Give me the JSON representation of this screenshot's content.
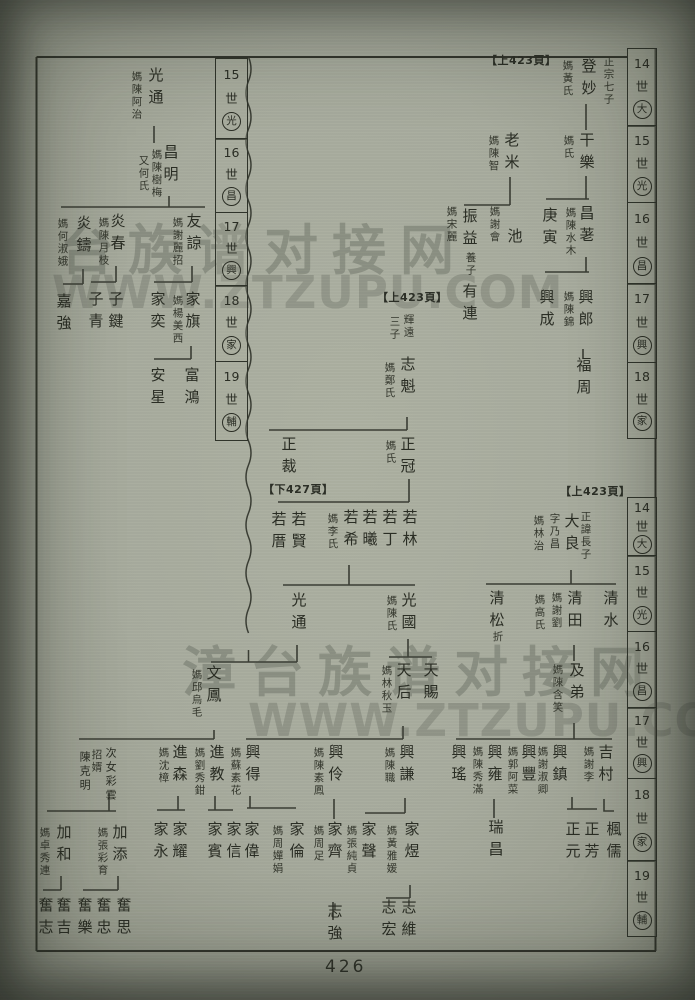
{
  "page": {
    "number": "426"
  },
  "colors": {
    "paper": "#a7ab9d",
    "ink": "#2a2d24",
    "line": "#3a3d34"
  },
  "watermarks": [
    {
      "text": "台族谱对接网",
      "x": 60,
      "y": 206,
      "size": 54,
      "kind": "cn"
    },
    {
      "text": "WWW.ZTZUPU.COM",
      "x": 52,
      "y": 266,
      "size": 45,
      "kind": "url"
    },
    {
      "text": "漳台族谱对接网",
      "x": 182,
      "y": 628,
      "size": 54,
      "kind": "cn"
    },
    {
      "text": "WWW.ZTZUPU.COM",
      "x": 248,
      "y": 694,
      "size": 45,
      "kind": "url"
    }
  ],
  "refs": [
    {
      "text": "【上423頁】",
      "x": 486,
      "y": 52
    },
    {
      "text": "【上423頁】",
      "x": 377,
      "y": 289
    },
    {
      "text": "【下427頁】",
      "x": 263,
      "y": 481
    },
    {
      "text": "【上423頁】",
      "x": 560,
      "y": 483
    }
  ],
  "bands": [
    {
      "x": 627,
      "y": 48,
      "w": 30,
      "cells": [
        {
          "n": "14",
          "g": "大",
          "h": 79
        },
        {
          "n": "15",
          "g": "光",
          "h": 78
        },
        {
          "n": "16",
          "g": "昌",
          "h": 83
        },
        {
          "n": "17",
          "g": "興",
          "h": 80
        },
        {
          "n": "18",
          "g": "家",
          "h": 77
        }
      ]
    },
    {
      "x": 627,
      "y": 497,
      "w": 30,
      "cells": [
        {
          "n": "14",
          "g": "大",
          "h": 60
        },
        {
          "n": "15",
          "g": "光",
          "h": 77
        },
        {
          "n": "16",
          "g": "昌",
          "h": 78
        },
        {
          "n": "17",
          "g": "興",
          "h": 72
        },
        {
          "n": "18",
          "g": "家",
          "h": 84
        },
        {
          "n": "19",
          "g": "輔",
          "h": 77
        }
      ]
    },
    {
      "x": 215,
      "y": 58,
      "w": 33,
      "cells": [
        {
          "n": "15",
          "g": "光",
          "h": 82
        },
        {
          "n": "16",
          "g": "昌",
          "h": 75
        },
        {
          "n": "17",
          "g": "興",
          "h": 75
        },
        {
          "n": "18",
          "g": "家",
          "h": 77
        },
        {
          "n": "19",
          "g": "輔",
          "h": 80
        }
      ]
    }
  ],
  "people": [
    {
      "t": "正宗七子",
      "x": 602,
      "y": 56,
      "s": 10,
      "k": "note"
    },
    {
      "t": "登妙",
      "x": 580,
      "y": 58,
      "s": 15,
      "k": "name"
    },
    {
      "t": "媽黃氏",
      "x": 561,
      "y": 60,
      "s": 10,
      "k": "spouse"
    },
    {
      "t": "干樂",
      "x": 578,
      "y": 132,
      "s": 15,
      "k": "name"
    },
    {
      "t": "媽氏",
      "x": 562,
      "y": 135,
      "s": 10,
      "k": "spouse"
    },
    {
      "t": "老米",
      "x": 503,
      "y": 132,
      "s": 15,
      "k": "name"
    },
    {
      "t": "媽陳智",
      "x": 487,
      "y": 135,
      "s": 10,
      "k": "spouse"
    },
    {
      "t": "昌荖",
      "x": 578,
      "y": 205,
      "s": 15,
      "k": "name"
    },
    {
      "t": "媽陳水木",
      "x": 564,
      "y": 207,
      "s": 10,
      "k": "spouse"
    },
    {
      "t": "庚寅",
      "x": 541,
      "y": 207,
      "s": 15,
      "k": "name"
    },
    {
      "t": "池",
      "x": 506,
      "y": 228,
      "s": 15,
      "k": "name"
    },
    {
      "t": "媽謝會",
      "x": 488,
      "y": 206,
      "s": 10,
      "k": "spouse"
    },
    {
      "t": "振益",
      "x": 461,
      "y": 208,
      "s": 15,
      "k": "name"
    },
    {
      "t": "養子",
      "x": 464,
      "y": 252,
      "s": 10,
      "k": "note"
    },
    {
      "t": "有連",
      "x": 461,
      "y": 283,
      "s": 15,
      "k": "name"
    },
    {
      "t": "媽宋麗",
      "x": 445,
      "y": 206,
      "s": 10,
      "k": "spouse"
    },
    {
      "t": "興郎",
      "x": 577,
      "y": 289,
      "s": 15,
      "k": "name"
    },
    {
      "t": "媽陳錦",
      "x": 562,
      "y": 291,
      "s": 10,
      "k": "spouse"
    },
    {
      "t": "興成",
      "x": 538,
      "y": 289,
      "s": 15,
      "k": "name"
    },
    {
      "t": "福周",
      "x": 575,
      "y": 357,
      "s": 15,
      "k": "name"
    },
    {
      "t": "正諱長子",
      "x": 579,
      "y": 511,
      "s": 10,
      "k": "note"
    },
    {
      "t": "大良",
      "x": 563,
      "y": 513,
      "s": 15,
      "k": "name"
    },
    {
      "t": "字乃昌",
      "x": 548,
      "y": 513,
      "s": 10,
      "k": "note"
    },
    {
      "t": "媽林治",
      "x": 532,
      "y": 515,
      "s": 10,
      "k": "spouse"
    },
    {
      "t": "清水",
      "x": 602,
      "y": 590,
      "s": 15,
      "k": "name"
    },
    {
      "t": "清田",
      "x": 566,
      "y": 590,
      "s": 15,
      "k": "name"
    },
    {
      "t": "媽謝劉",
      "x": 550,
      "y": 592,
      "s": 10,
      "k": "spouse"
    },
    {
      "t": "媽高氏",
      "x": 533,
      "y": 594,
      "s": 10,
      "k": "spouse"
    },
    {
      "t": "清松",
      "x": 488,
      "y": 590,
      "s": 15,
      "k": "name"
    },
    {
      "t": "折",
      "x": 491,
      "y": 631,
      "s": 10,
      "k": "note"
    },
    {
      "t": "及弟",
      "x": 568,
      "y": 662,
      "s": 15,
      "k": "name"
    },
    {
      "t": "媽陳含笑",
      "x": 551,
      "y": 664,
      "s": 10,
      "k": "spouse"
    },
    {
      "t": "吉村",
      "x": 597,
      "y": 744,
      "s": 15,
      "k": "name"
    },
    {
      "t": "媽謝李",
      "x": 582,
      "y": 746,
      "s": 10,
      "k": "spouse"
    },
    {
      "t": "興鎮",
      "x": 551,
      "y": 744,
      "s": 15,
      "k": "name"
    },
    {
      "t": "媽謝淑卿",
      "x": 536,
      "y": 746,
      "s": 10,
      "k": "spouse"
    },
    {
      "t": "興豐",
      "x": 520,
      "y": 744,
      "s": 15,
      "k": "name"
    },
    {
      "t": "媽郭阿菜",
      "x": 506,
      "y": 746,
      "s": 10,
      "k": "spouse"
    },
    {
      "t": "興雍",
      "x": 486,
      "y": 744,
      "s": 15,
      "k": "name"
    },
    {
      "t": "媽陳秀滿",
      "x": 471,
      "y": 746,
      "s": 10,
      "k": "spouse"
    },
    {
      "t": "興瑤",
      "x": 450,
      "y": 744,
      "s": 15,
      "k": "name"
    },
    {
      "t": "楓儒",
      "x": 605,
      "y": 821,
      "s": 15,
      "k": "name"
    },
    {
      "t": "正芳",
      "x": 583,
      "y": 821,
      "s": 15,
      "k": "name"
    },
    {
      "t": "正元",
      "x": 564,
      "y": 821,
      "s": 15,
      "k": "name"
    },
    {
      "t": "瑞昌",
      "x": 487,
      "y": 819,
      "s": 15,
      "k": "name"
    },
    {
      "t": "光通",
      "x": 147,
      "y": 67,
      "s": 15,
      "k": "name"
    },
    {
      "t": "媽陳阿治",
      "x": 130,
      "y": 71,
      "s": 10,
      "k": "spouse"
    },
    {
      "t": "昌明",
      "x": 162,
      "y": 144,
      "s": 15,
      "k": "name"
    },
    {
      "t": "媽陳樹梅",
      "x": 150,
      "y": 149,
      "s": 10,
      "k": "spouse"
    },
    {
      "t": "又何氏",
      "x": 137,
      "y": 155,
      "s": 10,
      "k": "spouse"
    },
    {
      "t": "友諒",
      "x": 185,
      "y": 213,
      "s": 15,
      "k": "name"
    },
    {
      "t": "媽謝麗招",
      "x": 171,
      "y": 217,
      "s": 10,
      "k": "spouse"
    },
    {
      "t": "炎春",
      "x": 109,
      "y": 213,
      "s": 15,
      "k": "name"
    },
    {
      "t": "媽陳月枝",
      "x": 97,
      "y": 217,
      "s": 10,
      "k": "spouse"
    },
    {
      "t": "炎鑄",
      "x": 75,
      "y": 215,
      "s": 15,
      "k": "name"
    },
    {
      "t": "媽何淑娥",
      "x": 56,
      "y": 218,
      "s": 10,
      "k": "spouse"
    },
    {
      "t": "家旗",
      "x": 184,
      "y": 291,
      "s": 15,
      "k": "name"
    },
    {
      "t": "媽楊美西",
      "x": 171,
      "y": 295,
      "s": 10,
      "k": "spouse"
    },
    {
      "t": "家奕",
      "x": 149,
      "y": 291,
      "s": 15,
      "k": "name"
    },
    {
      "t": "子鍵",
      "x": 107,
      "y": 291,
      "s": 15,
      "k": "name"
    },
    {
      "t": "子青",
      "x": 87,
      "y": 291,
      "s": 15,
      "k": "name"
    },
    {
      "t": "嘉強",
      "x": 55,
      "y": 293,
      "s": 15,
      "k": "name"
    },
    {
      "t": "富鴻",
      "x": 183,
      "y": 367,
      "s": 15,
      "k": "name"
    },
    {
      "t": "安星",
      "x": 149,
      "y": 367,
      "s": 15,
      "k": "name"
    },
    {
      "t": "輝遠",
      "x": 402,
      "y": 314,
      "s": 10,
      "k": "note"
    },
    {
      "t": "三子",
      "x": 388,
      "y": 316,
      "s": 10,
      "k": "note"
    },
    {
      "t": "志魁",
      "x": 399,
      "y": 356,
      "s": 15,
      "k": "name"
    },
    {
      "t": "媽鄭氏",
      "x": 383,
      "y": 362,
      "s": 10,
      "k": "spouse"
    },
    {
      "t": "正冠",
      "x": 399,
      "y": 436,
      "s": 15,
      "k": "name"
    },
    {
      "t": "媽氏",
      "x": 384,
      "y": 440,
      "s": 10,
      "k": "spouse"
    },
    {
      "t": "正裁",
      "x": 280,
      "y": 436,
      "s": 15,
      "k": "name"
    },
    {
      "t": "若林",
      "x": 401,
      "y": 509,
      "s": 15,
      "k": "name"
    },
    {
      "t": "若丁",
      "x": 381,
      "y": 509,
      "s": 15,
      "k": "name"
    },
    {
      "t": "若曦",
      "x": 361,
      "y": 509,
      "s": 15,
      "k": "name"
    },
    {
      "t": "若希",
      "x": 342,
      "y": 509,
      "s": 15,
      "k": "name"
    },
    {
      "t": "媽李氏",
      "x": 326,
      "y": 513,
      "s": 10,
      "k": "spouse"
    },
    {
      "t": "若賢",
      "x": 290,
      "y": 511,
      "s": 15,
      "k": "name"
    },
    {
      "t": "若厝",
      "x": 270,
      "y": 511,
      "s": 15,
      "k": "name"
    },
    {
      "t": "光國",
      "x": 400,
      "y": 592,
      "s": 15,
      "k": "name"
    },
    {
      "t": "媽陳氏",
      "x": 385,
      "y": 595,
      "s": 10,
      "k": "spouse"
    },
    {
      "t": "光通",
      "x": 290,
      "y": 592,
      "s": 15,
      "k": "name"
    },
    {
      "t": "天賜",
      "x": 422,
      "y": 662,
      "s": 15,
      "k": "name"
    },
    {
      "t": "天后",
      "x": 395,
      "y": 662,
      "s": 15,
      "k": "name"
    },
    {
      "t": "媽林秋玉",
      "x": 380,
      "y": 665,
      "s": 10,
      "k": "spouse"
    },
    {
      "t": "文鳳",
      "x": 205,
      "y": 665,
      "s": 15,
      "k": "name"
    },
    {
      "t": "媽邱烏毛",
      "x": 190,
      "y": 669,
      "s": 10,
      "k": "spouse"
    },
    {
      "t": "興謙",
      "x": 398,
      "y": 744,
      "s": 15,
      "k": "name"
    },
    {
      "t": "媽陳職",
      "x": 383,
      "y": 747,
      "s": 10,
      "k": "spouse"
    },
    {
      "t": "興伶",
      "x": 327,
      "y": 744,
      "s": 15,
      "k": "name"
    },
    {
      "t": "媽陳素鳳",
      "x": 312,
      "y": 747,
      "s": 10,
      "k": "spouse"
    },
    {
      "t": "興得",
      "x": 244,
      "y": 744,
      "s": 15,
      "k": "name"
    },
    {
      "t": "媽蘇素花",
      "x": 229,
      "y": 747,
      "s": 10,
      "k": "spouse"
    },
    {
      "t": "進教",
      "x": 208,
      "y": 744,
      "s": 15,
      "k": "name"
    },
    {
      "t": "媽劉秀鉗",
      "x": 193,
      "y": 747,
      "s": 10,
      "k": "spouse"
    },
    {
      "t": "進森",
      "x": 171,
      "y": 744,
      "s": 15,
      "k": "name"
    },
    {
      "t": "媽沈樟",
      "x": 157,
      "y": 747,
      "s": 10,
      "k": "spouse"
    },
    {
      "t": "次女彩雲",
      "x": 104,
      "y": 747,
      "s": 11,
      "k": "note"
    },
    {
      "t": "招婿",
      "x": 90,
      "y": 749,
      "s": 10,
      "k": "note"
    },
    {
      "t": "陳克明",
      "x": 78,
      "y": 751,
      "s": 11,
      "k": "name"
    },
    {
      "t": "家煜",
      "x": 403,
      "y": 821,
      "s": 15,
      "k": "name"
    },
    {
      "t": "媽黃雅媛",
      "x": 385,
      "y": 825,
      "s": 10,
      "k": "spouse"
    },
    {
      "t": "家聲",
      "x": 360,
      "y": 821,
      "s": 15,
      "k": "name"
    },
    {
      "t": "媽張純貞",
      "x": 345,
      "y": 825,
      "s": 10,
      "k": "spouse"
    },
    {
      "t": "家齊",
      "x": 326,
      "y": 821,
      "s": 15,
      "k": "name"
    },
    {
      "t": "媽周足",
      "x": 312,
      "y": 825,
      "s": 10,
      "k": "spouse"
    },
    {
      "t": "家倫",
      "x": 288,
      "y": 821,
      "s": 15,
      "k": "name"
    },
    {
      "t": "媽周嬋娟",
      "x": 271,
      "y": 825,
      "s": 10,
      "k": "spouse"
    },
    {
      "t": "家偉",
      "x": 243,
      "y": 821,
      "s": 15,
      "k": "name"
    },
    {
      "t": "家信",
      "x": 225,
      "y": 821,
      "s": 15,
      "k": "name"
    },
    {
      "t": "家賓",
      "x": 206,
      "y": 821,
      "s": 15,
      "k": "name"
    },
    {
      "t": "家耀",
      "x": 171,
      "y": 821,
      "s": 15,
      "k": "name"
    },
    {
      "t": "家永",
      "x": 152,
      "y": 821,
      "s": 15,
      "k": "name"
    },
    {
      "t": "加添",
      "x": 111,
      "y": 824,
      "s": 15,
      "k": "name"
    },
    {
      "t": "媽張彩育",
      "x": 96,
      "y": 827,
      "s": 10,
      "k": "spouse"
    },
    {
      "t": "加和",
      "x": 55,
      "y": 824,
      "s": 15,
      "k": "name"
    },
    {
      "t": "媽卓秀連",
      "x": 38,
      "y": 827,
      "s": 10,
      "k": "spouse"
    },
    {
      "t": "志維",
      "x": 400,
      "y": 899,
      "s": 15,
      "k": "name"
    },
    {
      "t": "志宏",
      "x": 380,
      "y": 899,
      "s": 15,
      "k": "name"
    },
    {
      "t": "志強",
      "x": 326,
      "y": 903,
      "s": 15,
      "k": "name"
    },
    {
      "t": "奮思",
      "x": 115,
      "y": 897,
      "s": 15,
      "k": "name"
    },
    {
      "t": "奮忠",
      "x": 95,
      "y": 897,
      "s": 15,
      "k": "name"
    },
    {
      "t": "奮樂",
      "x": 76,
      "y": 897,
      "s": 15,
      "k": "name"
    },
    {
      "t": "奮吉",
      "x": 55,
      "y": 897,
      "s": 15,
      "k": "name"
    },
    {
      "t": "奮志",
      "x": 37,
      "y": 897,
      "s": 15,
      "k": "name"
    }
  ]
}
